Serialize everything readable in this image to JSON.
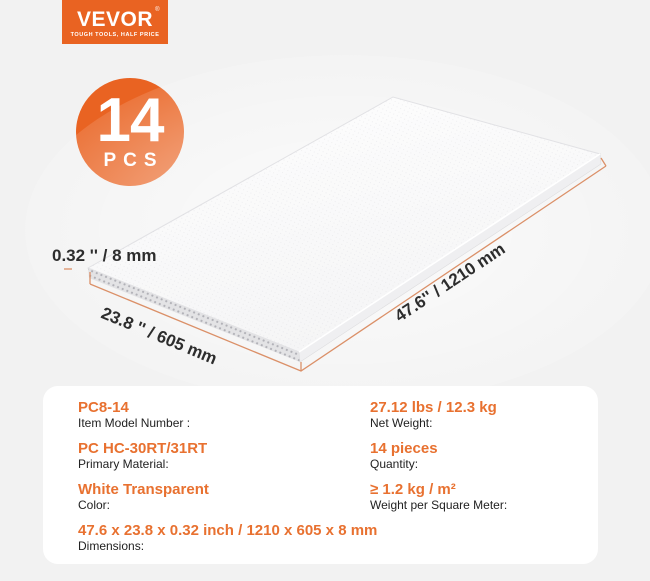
{
  "brand": {
    "logo_text": "VEVOR",
    "logo_registered": "®",
    "logo_tagline": "TOUGH TOOLS, HALF PRICE"
  },
  "badge": {
    "count": "14",
    "unit": "PCS"
  },
  "diagram": {
    "thickness_label": "0.32 '' / 8 mm",
    "width_label": "23.8 '' / 605 mm",
    "length_label": "47.6'' / 1210 mm"
  },
  "specs": {
    "left": [
      {
        "value": "PC8-14",
        "label": "Item Model Number :"
      },
      {
        "value": "PC HC-30RT/31RT",
        "label": "Primary Material:"
      },
      {
        "value": "White Transparent",
        "label": "Color:"
      },
      {
        "value": "47.6 x 23.8 x 0.32 inch / 1210 x 605 x 8 mm",
        "label": "Dimensions:"
      }
    ],
    "right": [
      {
        "value": "27.12 lbs / 12.3 kg",
        "label": "Net Weight:"
      },
      {
        "value": "14 pieces",
        "label": "Quantity:"
      },
      {
        "value": "≥ 1.2 kg / m²",
        "label": "Weight per Square Meter:"
      }
    ]
  },
  "colors": {
    "brand_orange": "#E96322",
    "accent_text": "#E87130",
    "dimension_line": "#DB9068",
    "page_bg": "#F2F2F2",
    "card_bg": "#FFFFFF",
    "text_dark": "#222222"
  }
}
